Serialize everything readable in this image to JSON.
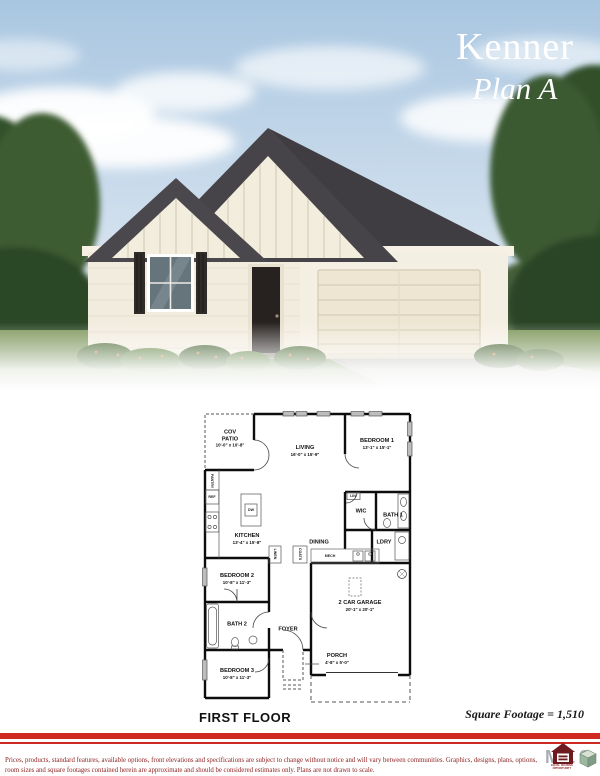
{
  "header": {
    "plan_name": "Kenner",
    "plan_variant": "Plan A"
  },
  "floor_plan": {
    "floor_label": "FIRST FLOOR",
    "square_footage_note": "Square Footage = 1,510",
    "rooms": [
      {
        "name": "COV PATIO",
        "dims": "10'-0\" x 10'-8\""
      },
      {
        "name": "LIVING",
        "dims": "16'-0\" x 15'-9\""
      },
      {
        "name": "BEDROOM 1",
        "dims": "13'-1\" x 15'-1\""
      },
      {
        "name": "KITCHEN",
        "dims": "13'-4\" x 15'-8\""
      },
      {
        "name": "DINING",
        "dims": ""
      },
      {
        "name": "WIC",
        "dims": ""
      },
      {
        "name": "BATH 1",
        "dims": ""
      },
      {
        "name": "LDRY",
        "dims": ""
      },
      {
        "name": "BEDROOM 2",
        "dims": "10'-8\" x 11'-3\""
      },
      {
        "name": "BATH 2",
        "dims": ""
      },
      {
        "name": "FOYER",
        "dims": ""
      },
      {
        "name": "2 CAR GARAGE",
        "dims": "20'-1\" x 20'-1\""
      },
      {
        "name": "PORCH",
        "dims": "4'-8\" x 5'-0\""
      },
      {
        "name": "BEDROOM 3",
        "dims": "10'-8\" x 11'-3\""
      }
    ],
    "fixtures": {
      "pantry": "PANTRY",
      "ref": "REF",
      "dw": "DW",
      "lin": "LIN",
      "linen": "LINEN",
      "coats": "COATS",
      "mech": "MECH"
    }
  },
  "footer": {
    "disclaimer": "Prices, products, standard features, available options, front elevations and specifications are subject to change without notice and will vary between communities.  Graphics, designs, plans, options, room sizes and square footages contained herein are approximate and should be considered estimates only.  Plans are not drawn to scale.",
    "logo_letters": "MLS",
    "logo_tagline": "EQUAL HOUSING OPPORTUNITY"
  },
  "colors": {
    "accent_red": "#cf2a22",
    "footer_text": "#8b1d1d",
    "sky": "#b9d2e6",
    "roof": "#454347",
    "brick": "#f1ebdd",
    "grass": "#6b8a4c"
  }
}
